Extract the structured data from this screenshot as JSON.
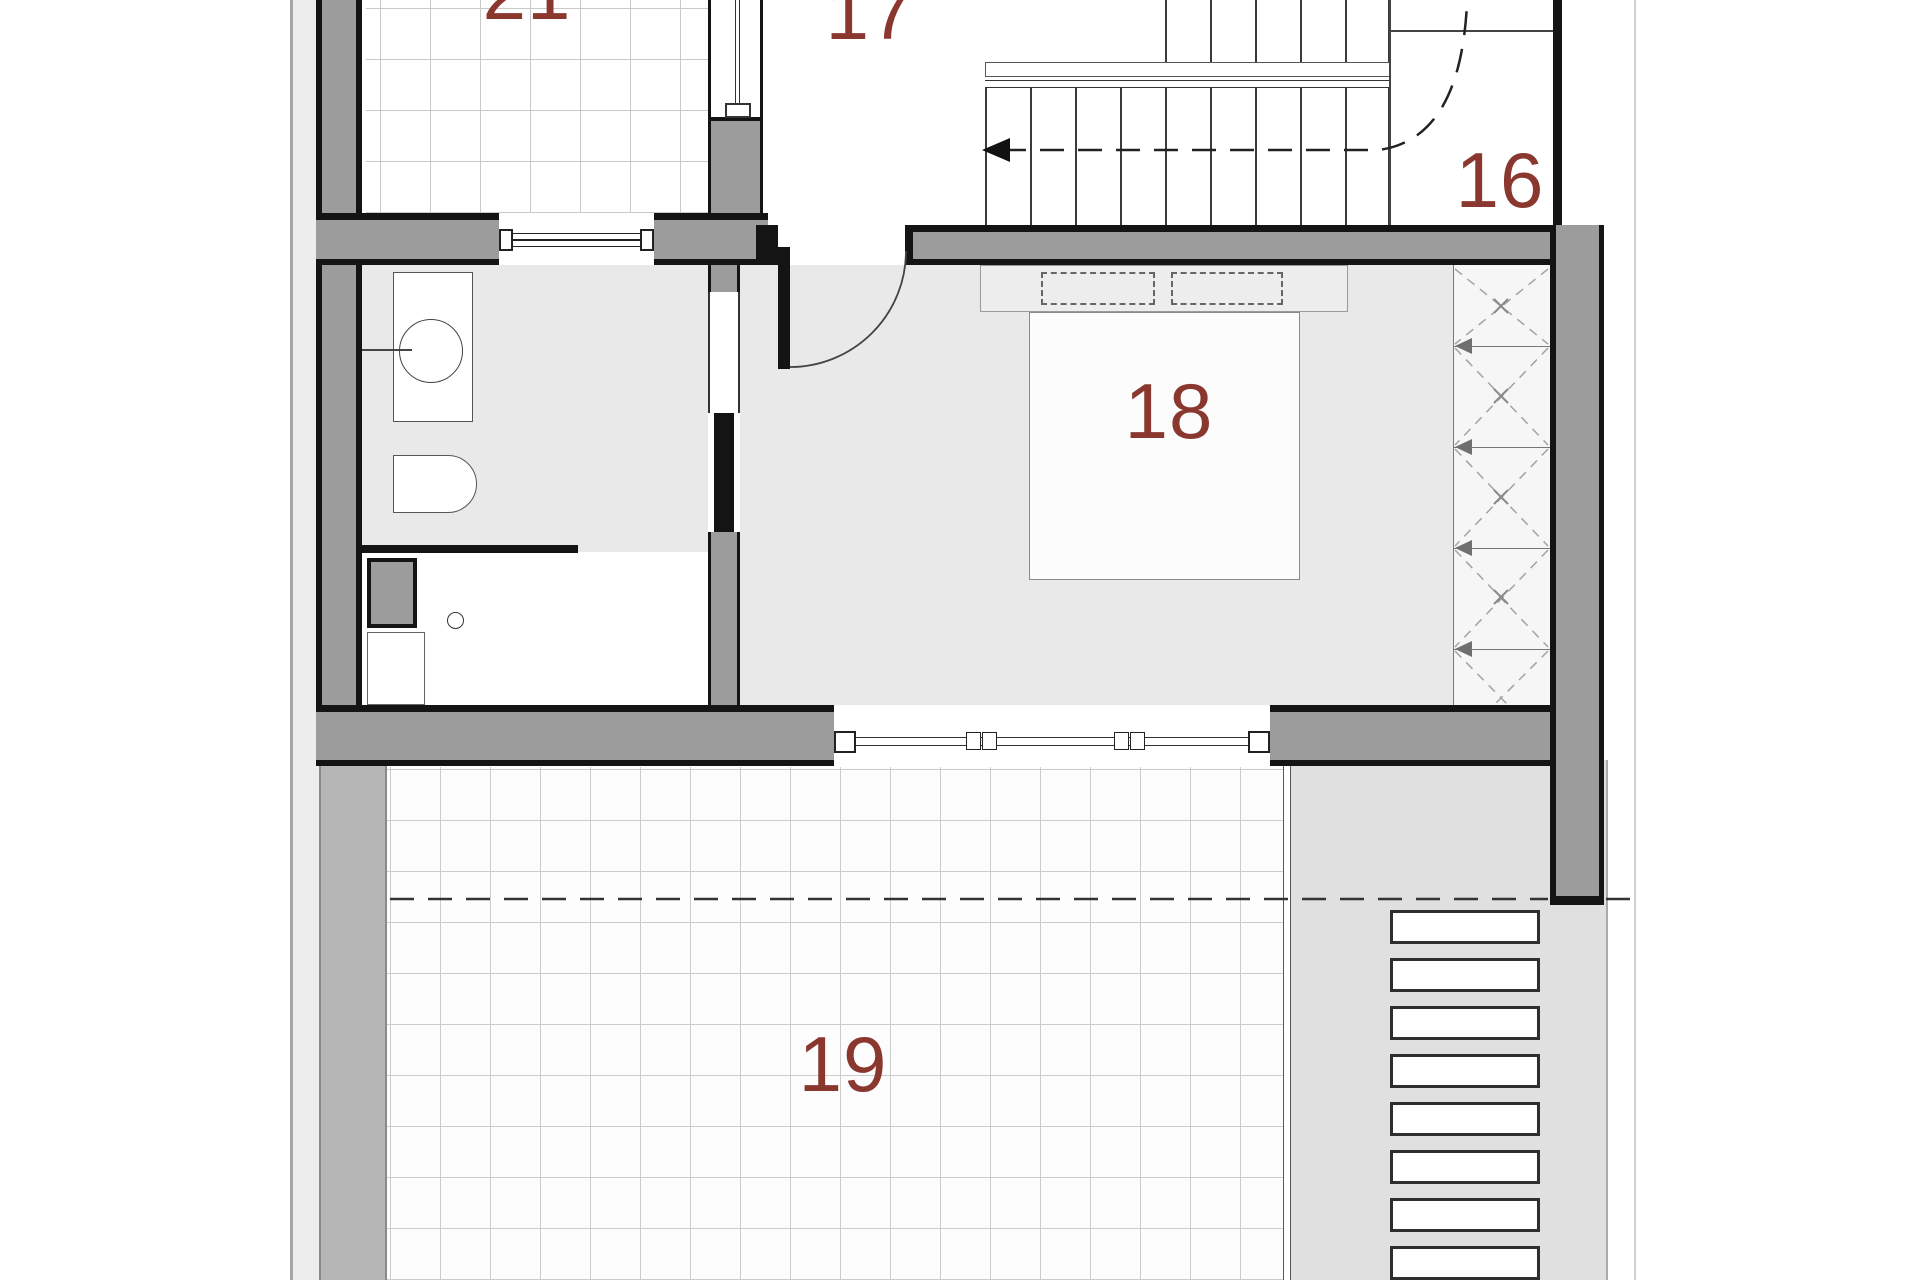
{
  "plan": {
    "title": "upper floor plan",
    "rooms": {
      "r21": {
        "number": "21"
      },
      "r17": {
        "number": "17"
      },
      "r16": {
        "number": "16"
      },
      "r18": {
        "number": "18"
      },
      "r19": {
        "number": "19"
      }
    },
    "colors": {
      "room_number": "#8a382f",
      "wall_fill": "#9c9c9c",
      "wall_edge": "#141414",
      "floor_light": "#e9e9e9",
      "terrace_wall": "#b6b6b6",
      "terrace_strip": "#e0e0e0",
      "grid_line": "#c9c9c9",
      "background": "#ffffff"
    }
  }
}
